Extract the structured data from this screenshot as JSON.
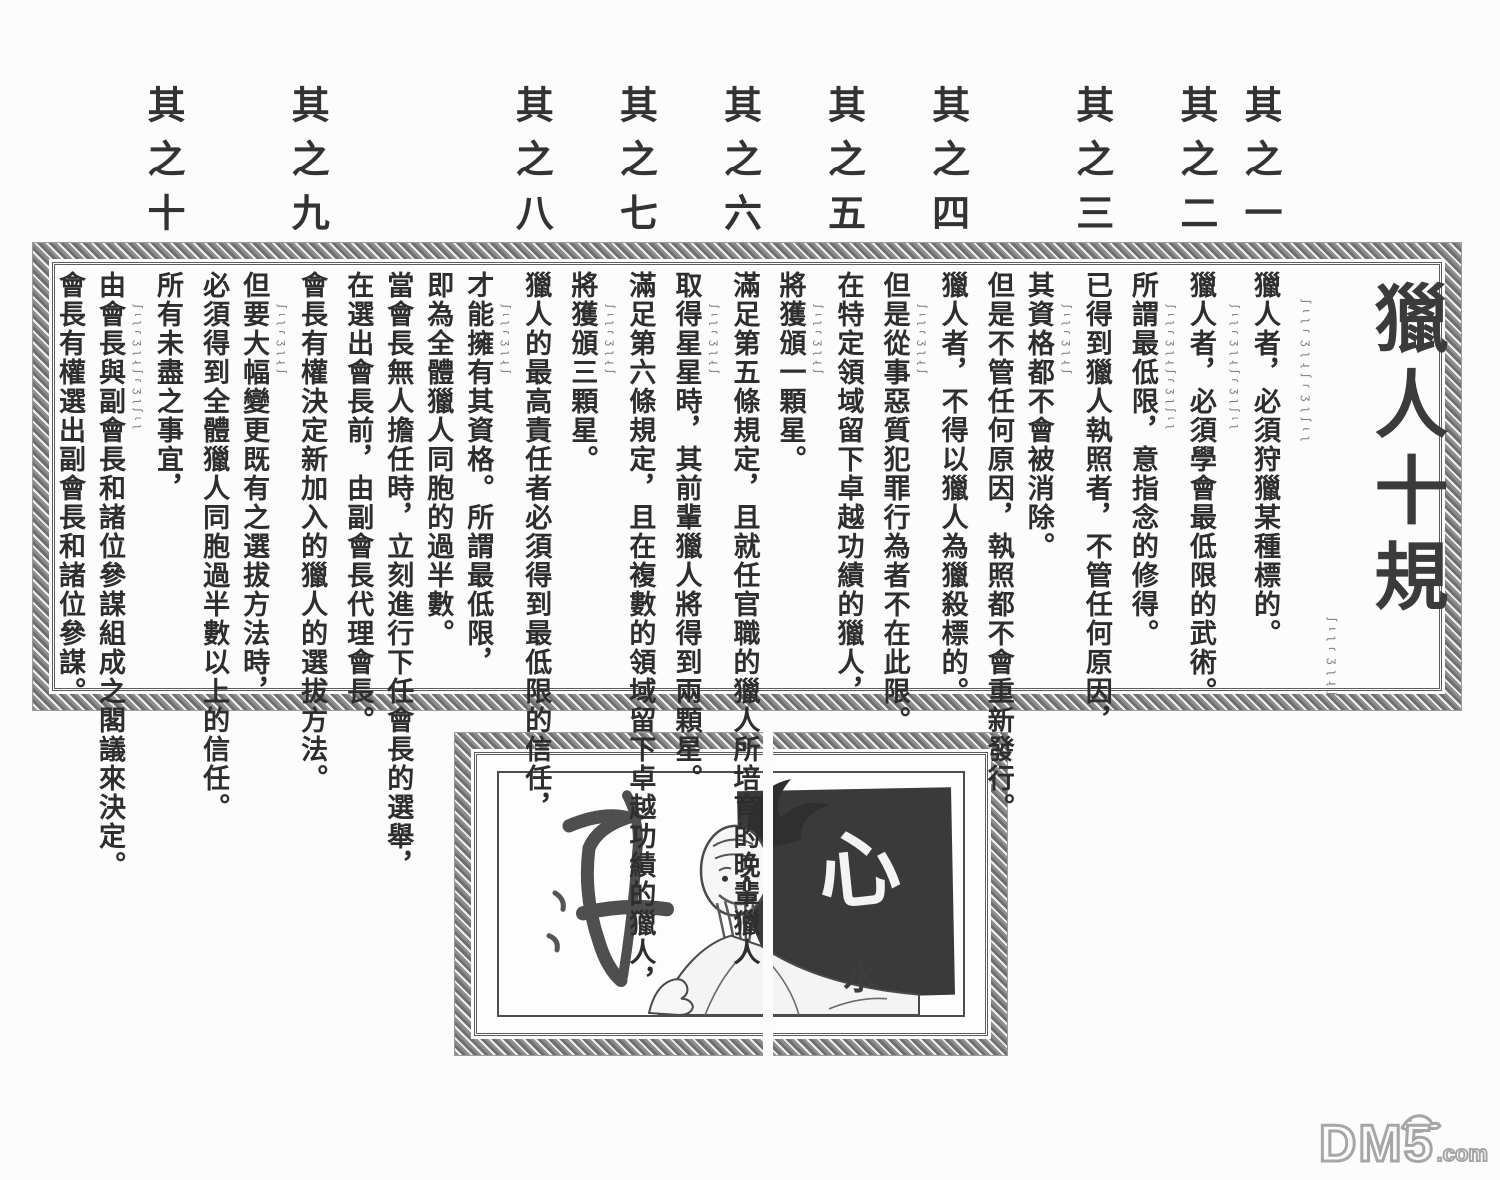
{
  "page": {
    "title": "獵人十規",
    "watermark": {
      "name": "DM5",
      "suffix": ".com"
    }
  },
  "rules": [
    {
      "header": "其之一",
      "columns": [
        "獵人者，必須狩獵某種標的。"
      ]
    },
    {
      "header": "其之二",
      "columns": [
        "獵人者，必須學會最低限的武術。",
        "所謂最低限，意指念的修得。"
      ]
    },
    {
      "header": "其之三",
      "columns": [
        "已得到獵人執照者，不管任何原因，",
        "其資格都不會被消除。",
        "但是不管任何原因，執照都不會重新發行。"
      ]
    },
    {
      "header": "其之四",
      "columns": [
        "獵人者，不得以獵人為獵殺標的。",
        "但是從事惡質犯罪行為者不在此限。"
      ]
    },
    {
      "header": "其之五",
      "columns": [
        "在特定領域留下卓越功績的獵人，",
        "將獲頒一顆星。"
      ]
    },
    {
      "header": "其之六",
      "columns": [
        "滿足第五條規定，且就任官職的獵人所培育的晚輩獵人",
        "取得星星時，其前輩獵人將得到兩顆星。"
      ]
    },
    {
      "header": "其之七",
      "columns": [
        "滿足第六條規定，且在複數的領域留下卓越功績的獵人，",
        "將獲頒三顆星。"
      ]
    },
    {
      "header": "其之八",
      "columns": [
        "獵人的最高責任者必須得到最低限的信任，",
        "才能擁有其資格。所謂最低限，",
        "即為全體獵人同胞的過半數。",
        "當會長無人擔任時，立刻進行下任會長的選舉，",
        "在選出會長前，由副會長代理會長。"
      ]
    },
    {
      "header": "其之九",
      "columns": [
        "會長有權決定新加入的獵人的選拔方法。",
        "但要大幅變更既有之選拔方法時，",
        "必須得到全體獵人同胞過半數以上的信任。"
      ]
    },
    {
      "header": "其之十",
      "columns": [
        "所有未盡之事宜，",
        "由會長與副會長和諸位參謀組成之閣議來決定。",
        "會長有權選出副會長和諸位參謀。"
      ]
    }
  ],
  "illustration": {
    "calligraphy_main": "心",
    "calligraphy_small": "水"
  },
  "decor": {
    "script_marks": "ʃɩʅɾʒʅɻʃ",
    "script_marks_long": "ʃɩʅɾʒʅɻʃɾʒʅʃɩʅ"
  },
  "colors": {
    "ink": "#2e2e2e",
    "frame_gray": "#8d8d8d",
    "dark_block": "#3a3a3a",
    "watermark_gray": "#a6a6a6",
    "paper": "#fcfcfc"
  }
}
